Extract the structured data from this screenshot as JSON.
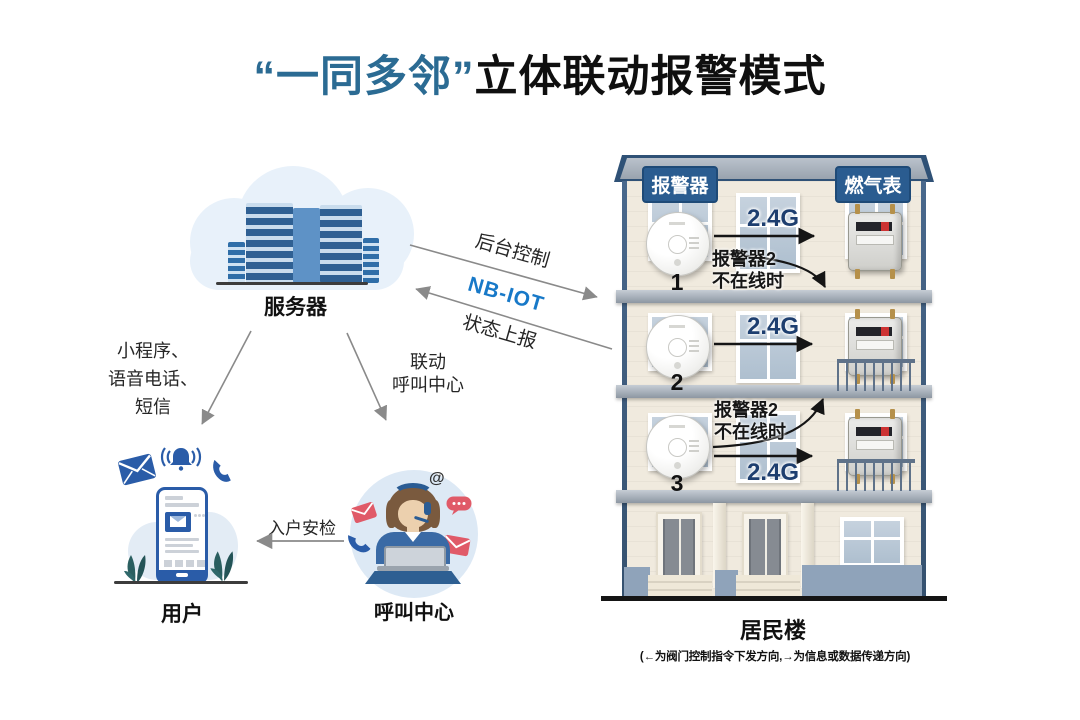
{
  "title": {
    "highlight": "“一同多邻”",
    "rest": "立体联动报警模式"
  },
  "server": {
    "label": "服务器"
  },
  "links": {
    "backend_control": "后台控制",
    "channel": "NB-IOT",
    "status_report": "状态上报"
  },
  "notify": {
    "line1": "小程序、",
    "line2": "语音电话、",
    "line3": "短信"
  },
  "linkage": {
    "line1": "联动",
    "line2": "呼叫中心"
  },
  "home_check": "入户安检",
  "user": {
    "label": "用户"
  },
  "call_center": {
    "label": "呼叫中心",
    "at_symbol": "@"
  },
  "building": {
    "label": "居民楼",
    "note": "(←为阀门控制指令下发方向,→为信息或数据传递方向)",
    "alarm_header": "报警器",
    "meter_header": "燃气表",
    "floors": [
      {
        "num": "1",
        "link": "2.4G",
        "fallback1": "报警器2",
        "fallback2": "不在线时"
      },
      {
        "num": "2",
        "link": "2.4G"
      },
      {
        "num": "3",
        "link": "2.4G",
        "fallback1": "报警器2",
        "fallback2": "不在线时"
      }
    ]
  },
  "colors": {
    "title_blue": "#2b6b93",
    "nbiot_blue": "#1879c8",
    "g24_navy": "#1d3e6f",
    "badge_blue": "#2a5c90",
    "icon_blue": "#2a5ca8",
    "alert_red": "#e05a68",
    "building_edge_blue": "#3a5a7e",
    "arrow_gray": "#8a8a8a",
    "arrow_black": "#151515"
  }
}
